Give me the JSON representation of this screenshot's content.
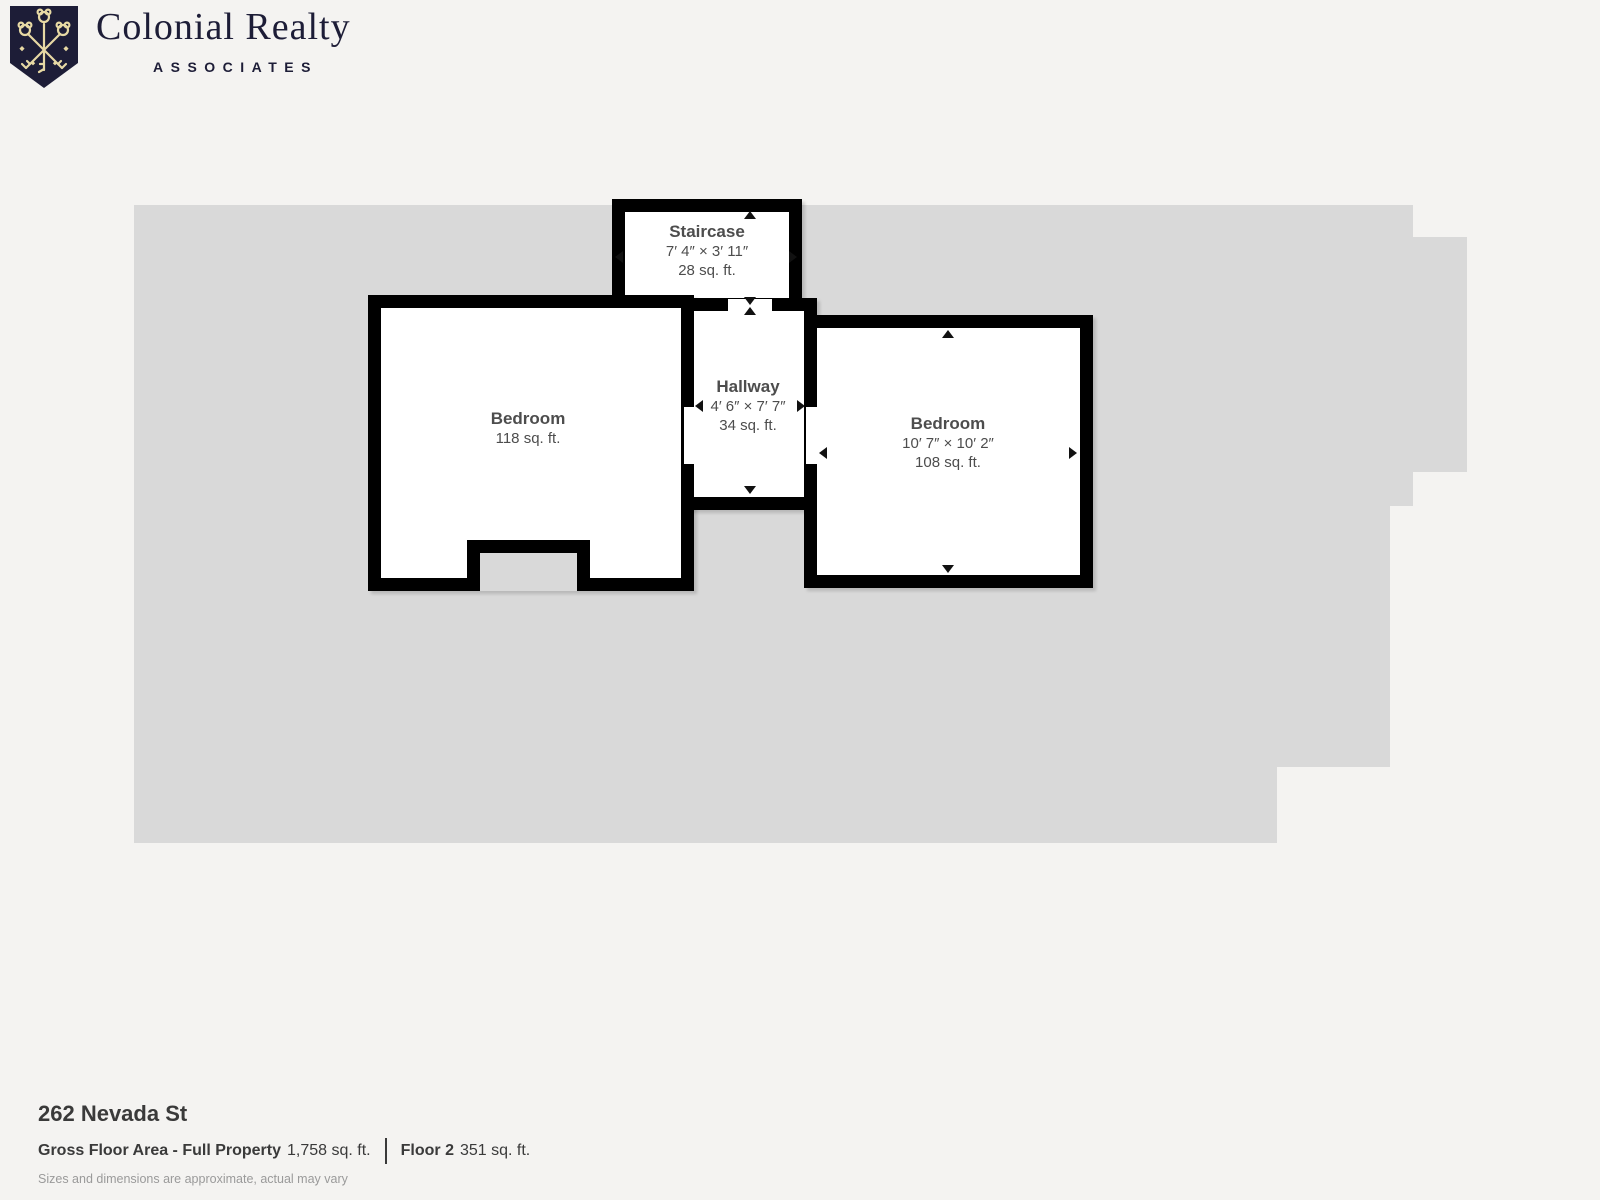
{
  "brand": {
    "name": "Colonial Realty",
    "subtitle": "ASSOCIATES",
    "navy": "#1d1d37",
    "gold": "#e7d9a4"
  },
  "rooms": {
    "staircase": {
      "name": "Staircase",
      "dimensions": "7′ 4″ × 3′ 11″",
      "area": "28 sq. ft."
    },
    "hallway": {
      "name": "Hallway",
      "dimensions": "4′ 6″ × 7′ 7″",
      "area": "34 sq. ft."
    },
    "bedroom_left": {
      "name": "Bedroom",
      "area": "118 sq. ft."
    },
    "bedroom_right": {
      "name": "Bedroom",
      "dimensions": "10′ 7″ × 10′ 2″",
      "area": "108 sq. ft."
    }
  },
  "footer": {
    "address": "262 Nevada St",
    "gross_label": "Gross Floor Area - Full Property",
    "gross_value": "1,758 sq. ft.",
    "floor_label": "Floor 2",
    "floor_value": "351 sq. ft.",
    "disclaimer": "Sizes and dimensions are approximate, actual may vary"
  },
  "colors": {
    "background": "#f4f3f1",
    "floor_silhouette": "#d9d9d9",
    "wall": "#000000",
    "room_fill": "#ffffff",
    "room_text": "#4d4d4d"
  }
}
